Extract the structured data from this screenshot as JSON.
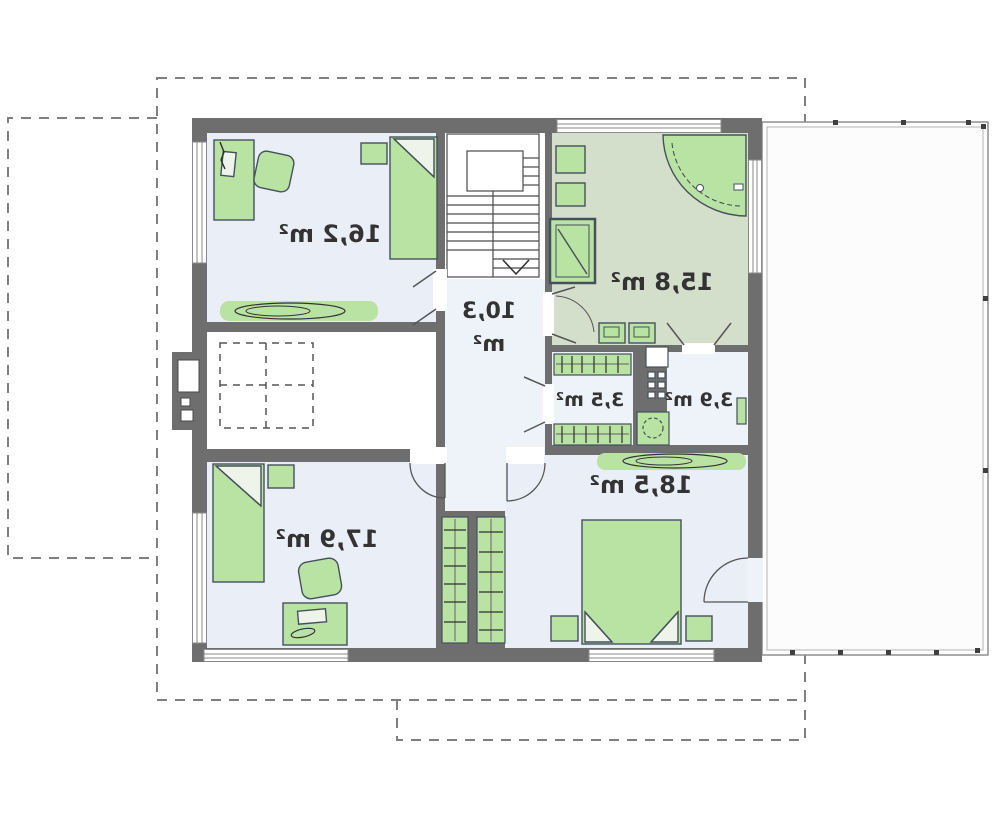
{
  "meta": {
    "drawing_type": "residential upper-floor plan",
    "text_mirrored": true
  },
  "rooms": [
    {
      "id": "bedroom-top-left",
      "label": "16,2 m²",
      "area_m2": 16.2
    },
    {
      "id": "bathroom",
      "label": "15,8 m²",
      "area_m2": 15.8
    },
    {
      "id": "hall",
      "label_line1": "10,3",
      "label_line2": "m²",
      "area_m2": 10.3
    },
    {
      "id": "wardrobe-closet",
      "label": "3,5 m²",
      "area_m2": 3.5
    },
    {
      "id": "utility-room",
      "label": "3,9 m²",
      "area_m2": 3.9
    },
    {
      "id": "bedroom-bottom-right",
      "label": "18,5 m²",
      "area_m2": 18.5
    },
    {
      "id": "bedroom-bottom-left",
      "label": "17,9 m²",
      "area_m2": 17.9
    }
  ],
  "colors": {
    "wall": "#6e6e6e",
    "room_floor": "#e9eef7",
    "hall_floor": "#eef2f9",
    "bathroom_floor": "#d4dfcb",
    "stair_floor": "#ffffff",
    "furniture_green": "#b9e3a2",
    "furniture_outline": "#45505c",
    "terrace_fill": "#fcfcfc",
    "dashed_outline": "#7f7f7f",
    "label_text": "#333333"
  }
}
